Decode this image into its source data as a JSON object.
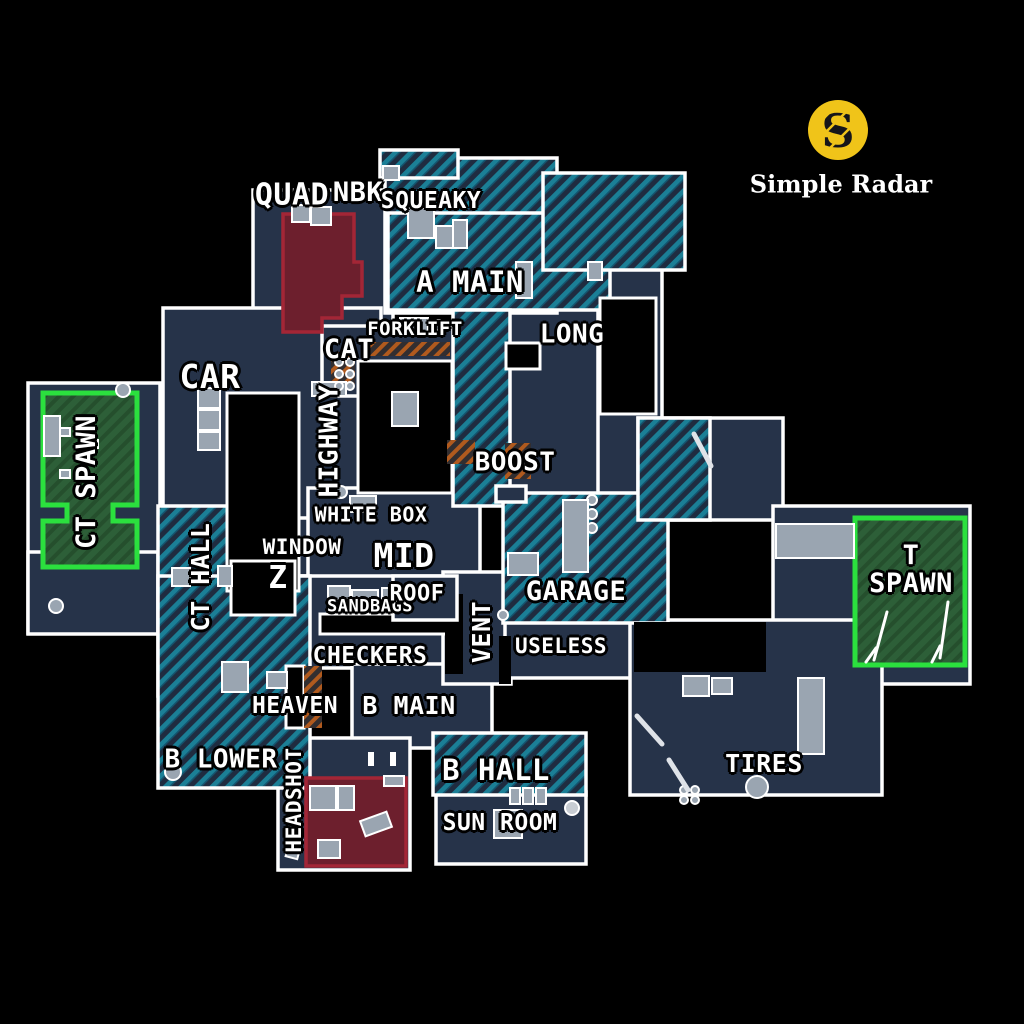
{
  "logo": {
    "brand": "Simple Radar",
    "monogram": "S"
  },
  "colors": {
    "background": "#000000",
    "floor": "#263349",
    "floor_hatch_base": "#1f2c40",
    "hatch_stripe": "#1b7f96",
    "hatch_stripe2": "#14546e",
    "green_hatch_stripe": "#254f2d",
    "wall": "#ffffff",
    "prop": "#9aa5b1",
    "void": "#000000",
    "red_room_fill": "#6d1f2d",
    "red_room_border": "#a32636",
    "green_room_fill": "#2d5f38",
    "green_room_border": "#2be03e",
    "ladder_base": "#322e30",
    "ladder_stripe": "#b05a1e",
    "logo_yellow": "#f0c419",
    "logo_s_color": "#16161a",
    "brand_text": "#ffffff",
    "label_text": "#ffffff",
    "label_outline": "#000000"
  },
  "map": {
    "labels": [
      {
        "id": "quad",
        "text": "QUAD",
        "x": 292,
        "y": 196,
        "size": 30,
        "rotate": 0
      },
      {
        "id": "nbk",
        "text": "NBK",
        "x": 358,
        "y": 193,
        "size": 27,
        "rotate": 0
      },
      {
        "id": "squeaky",
        "text": "SQUEAKY",
        "x": 431,
        "y": 202,
        "size": 23,
        "rotate": 0
      },
      {
        "id": "a-main",
        "text": "A MAIN",
        "x": 470,
        "y": 283,
        "size": 29,
        "rotate": 0
      },
      {
        "id": "long",
        "text": "LONG",
        "x": 572,
        "y": 335,
        "size": 26,
        "rotate": 0
      },
      {
        "id": "forklift",
        "text": "FORKLIFT",
        "x": 415,
        "y": 330,
        "size": 19,
        "rotate": 0
      },
      {
        "id": "cat",
        "text": "CAT",
        "x": 349,
        "y": 350,
        "size": 27,
        "rotate": 0
      },
      {
        "id": "car",
        "text": "CAR",
        "x": 210,
        "y": 377,
        "size": 33,
        "rotate": 0
      },
      {
        "id": "highway",
        "text": "HIGHWAY",
        "x": 330,
        "y": 441,
        "size": 26,
        "rotate": -90
      },
      {
        "id": "boost",
        "text": "BOOST",
        "x": 515,
        "y": 463,
        "size": 26,
        "rotate": 0
      },
      {
        "id": "white-box",
        "text": "WHITE BOX",
        "x": 371,
        "y": 515,
        "size": 20,
        "rotate": 0
      },
      {
        "id": "ct-spawn",
        "text": "CT SPAWN",
        "x": 87,
        "y": 482,
        "size": 27,
        "rotate": -90
      },
      {
        "id": "mid",
        "text": "MID",
        "x": 404,
        "y": 556,
        "size": 33,
        "rotate": 0
      },
      {
        "id": "window",
        "text": "WINDOW",
        "x": 302,
        "y": 548,
        "size": 21,
        "rotate": 0
      },
      {
        "id": "z",
        "text": "Z",
        "x": 278,
        "y": 579,
        "size": 31,
        "rotate": 0
      },
      {
        "id": "ct-hall",
        "text": "CT HALL",
        "x": 201,
        "y": 577,
        "size": 25,
        "rotate": -90
      },
      {
        "id": "sandbags",
        "text": "SANDBAGS",
        "x": 370,
        "y": 607,
        "size": 17,
        "rotate": 0
      },
      {
        "id": "roof",
        "text": "ROOF",
        "x": 417,
        "y": 595,
        "size": 22,
        "rotate": 0
      },
      {
        "id": "garage",
        "text": "GARAGE",
        "x": 576,
        "y": 592,
        "size": 27,
        "rotate": 0
      },
      {
        "id": "vent",
        "text": "VENT",
        "x": 482,
        "y": 632,
        "size": 25,
        "rotate": -90
      },
      {
        "id": "useless",
        "text": "USELESS",
        "x": 561,
        "y": 647,
        "size": 21,
        "rotate": 0
      },
      {
        "id": "checkers",
        "text": "CHECKERS",
        "x": 370,
        "y": 657,
        "size": 23,
        "rotate": 0
      },
      {
        "id": "heaven",
        "text": "HEAVEN",
        "x": 295,
        "y": 707,
        "size": 23,
        "rotate": 0
      },
      {
        "id": "b-main",
        "text": "B MAIN",
        "x": 409,
        "y": 706,
        "size": 25,
        "rotate": 0
      },
      {
        "id": "b-lower",
        "text": "B LOWER",
        "x": 221,
        "y": 760,
        "size": 26,
        "rotate": 0
      },
      {
        "id": "headshot",
        "text": "HEADSHOT",
        "x": 295,
        "y": 800,
        "size": 21,
        "rotate": -90
      },
      {
        "id": "b-hall",
        "text": "B HALL",
        "x": 496,
        "y": 771,
        "size": 29,
        "rotate": 0
      },
      {
        "id": "sun-room",
        "text": "SUN ROOM",
        "x": 500,
        "y": 824,
        "size": 23,
        "rotate": 0
      },
      {
        "id": "tires",
        "text": "TIRES",
        "x": 764,
        "y": 764,
        "size": 25,
        "rotate": 0
      },
      {
        "id": "t-spawn",
        "text": "T\nSPAWN",
        "x": 911,
        "y": 570,
        "size": 27,
        "rotate": 0
      }
    ]
  }
}
